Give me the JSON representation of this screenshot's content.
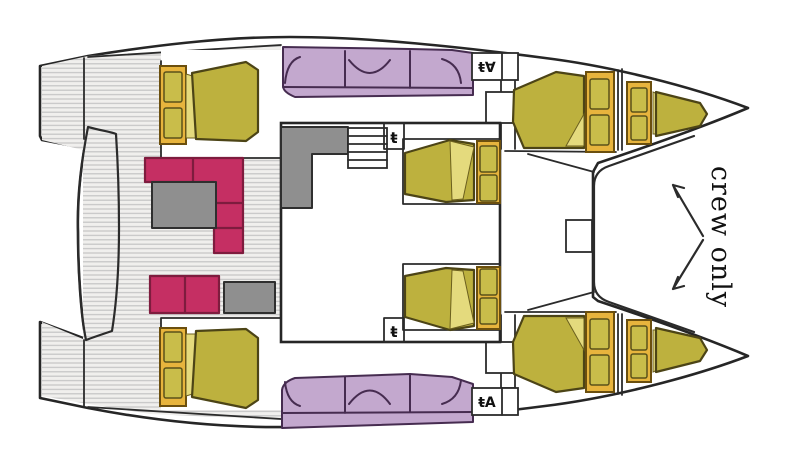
{
  "title": "Catamaran deck and cabin layout plan",
  "labels": {
    "crew_only": "crew only"
  },
  "icons": {
    "helm_station_top_glyph": "ŧ∀",
    "helm_station_bottom_glyph": "ŧA",
    "saloon_fixture_top_glyph": "ŧ",
    "saloon_fixture_bottom_glyph": "ŧ"
  },
  "colors": {
    "outline": "#2b2b2b",
    "deck_fill": "#f0efed",
    "deck_stripe": "#c4c4c4",
    "white": "#ffffff",
    "mattress": "#bdb13e",
    "mattress_fold": "#e4da7d",
    "pillow_frame": "#e7b43d",
    "pillow": "#c9bd4a",
    "sofa_pink": "#c52f63",
    "table_gray": "#8f8f8f",
    "seat_purple": "#c3a8ce",
    "text": "#1a1a1a"
  }
}
